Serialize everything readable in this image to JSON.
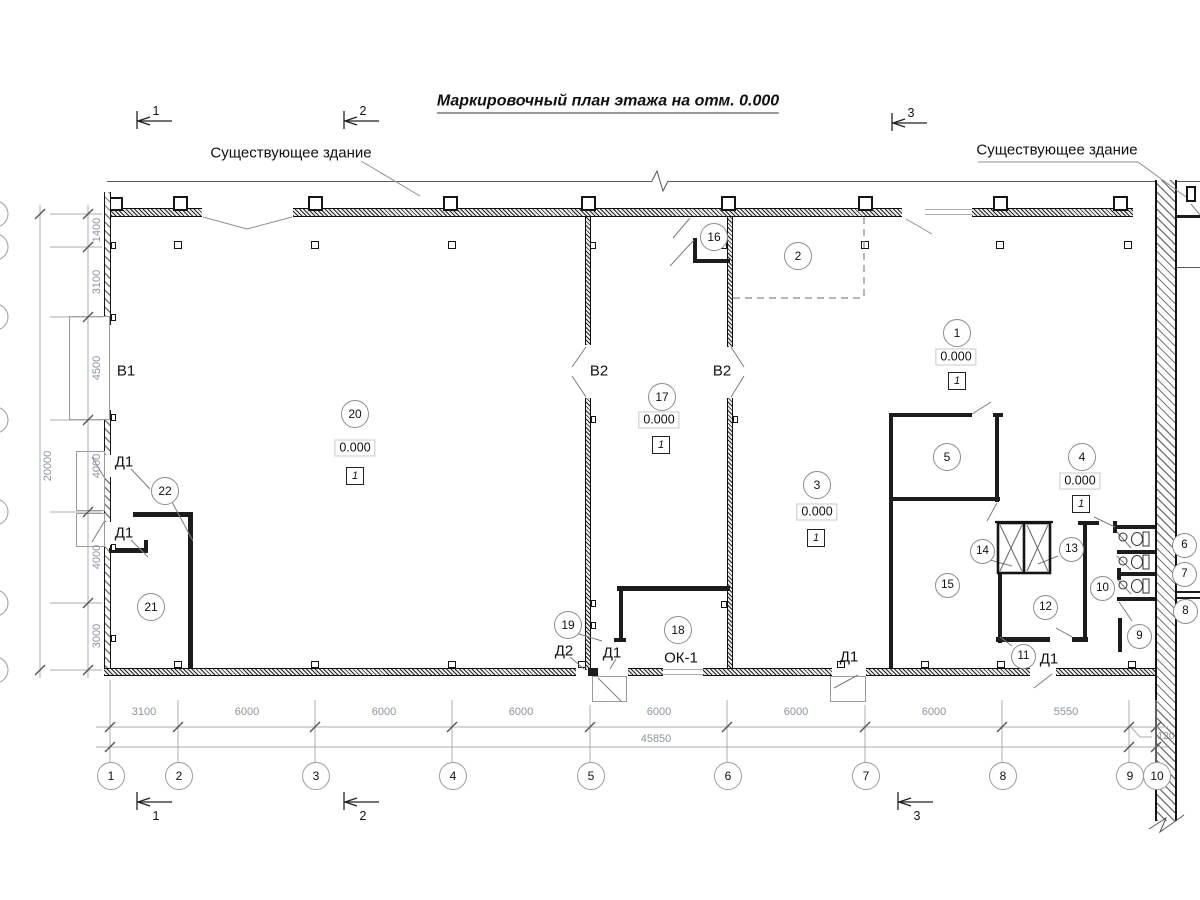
{
  "title": "Маркировочный план этажа на отм. 0.000",
  "existing_building_left": "Существующее здание",
  "existing_building_right": "Существующее здание",
  "section_marks": [
    "1",
    "2",
    "3"
  ],
  "elevation_value": "0.000",
  "floor_type": "1",
  "rooms": [
    "1",
    "2",
    "3",
    "4",
    "5",
    "6",
    "7",
    "8",
    "9",
    "10",
    "11",
    "12",
    "13",
    "14",
    "15",
    "16",
    "17",
    "18",
    "19",
    "20",
    "21",
    "22"
  ],
  "opening_labels": {
    "v1": "В1",
    "v2": "В2",
    "d1": "Д1",
    "d2": "Д2",
    "ok1": "ОК-1"
  },
  "dims_bottom": {
    "segments": [
      "3100",
      "6000",
      "6000",
      "6000",
      "6000",
      "6000",
      "6000",
      "5550"
    ],
    "total": "45850",
    "wall_offset": "120"
  },
  "dims_left": {
    "segments": [
      "1400",
      "3100",
      "4500",
      "4000",
      "4000",
      "3000"
    ],
    "total": "20000"
  },
  "grid_axes": [
    "1",
    "2",
    "3",
    "4",
    "5",
    "6",
    "7",
    "8",
    "9",
    "10"
  ]
}
